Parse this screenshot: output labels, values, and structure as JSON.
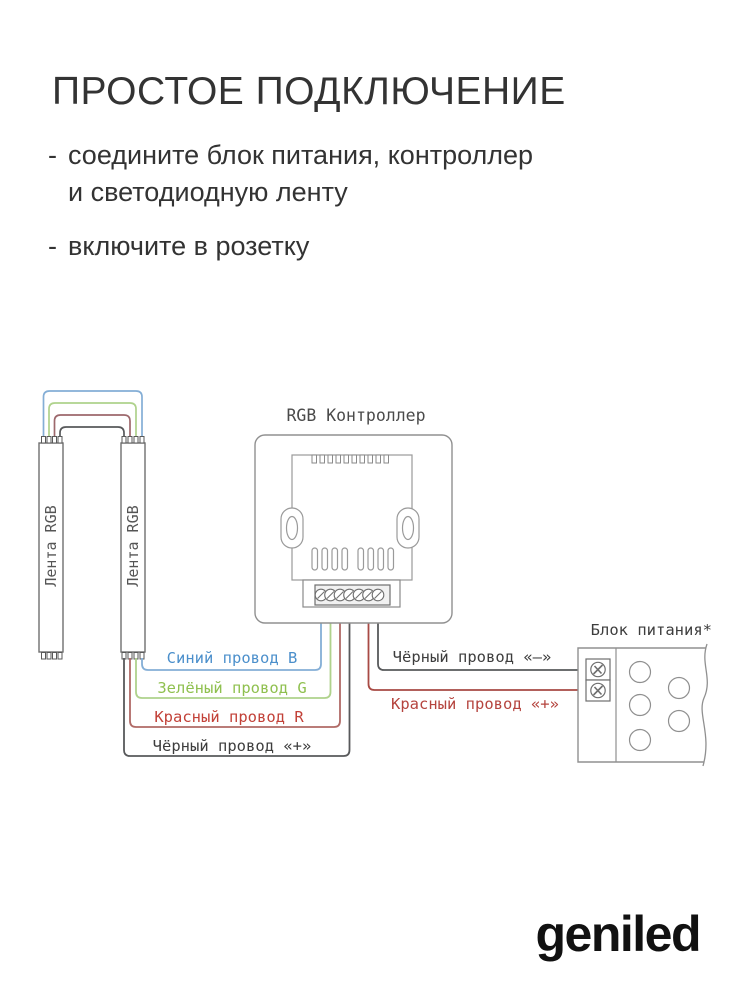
{
  "header": {
    "title": "ПРОСТОЕ ПОДКЛЮЧЕНИЕ",
    "bullets": [
      {
        "dash": "-",
        "lines": [
          "соедините блок питания, контроллер",
          "и светодиодную ленту"
        ]
      },
      {
        "dash": "-",
        "lines": [
          "включите в розетку",
          ""
        ]
      }
    ]
  },
  "diagram": {
    "controller": {
      "label": "RGB Контроллер"
    },
    "power_supply": {
      "label": "Блок питания*"
    },
    "strips": {
      "left_label": "Лента RGB",
      "right_label": "Лента RGB"
    },
    "wire_labels": {
      "blue": "Синий провод B",
      "green": "Зелёный провод G",
      "red": "Красный провод R",
      "black_plus": "Чёрный провод «+»",
      "black_minus": "Чёрный провод «–»",
      "red_plus": "Красный провод «+»"
    },
    "colors": {
      "blue_wire": "#84aed6",
      "green_wire": "#afd28c",
      "red_wire": "#9d686c",
      "red_wire_bottom": "#b06a66",
      "red_wire_psu": "#a84a44",
      "black_wire": "#58595b",
      "blue_text": "#4b8fcb",
      "green_text": "#8fc04f",
      "red_text": "#c24138",
      "red_plus_text": "#b5443e",
      "black_text": "#3d3d3d",
      "outline": "#909090",
      "outline_dark": "#777777",
      "strip_text": "#555555"
    }
  },
  "footer": {
    "logo_text": "geniled"
  }
}
